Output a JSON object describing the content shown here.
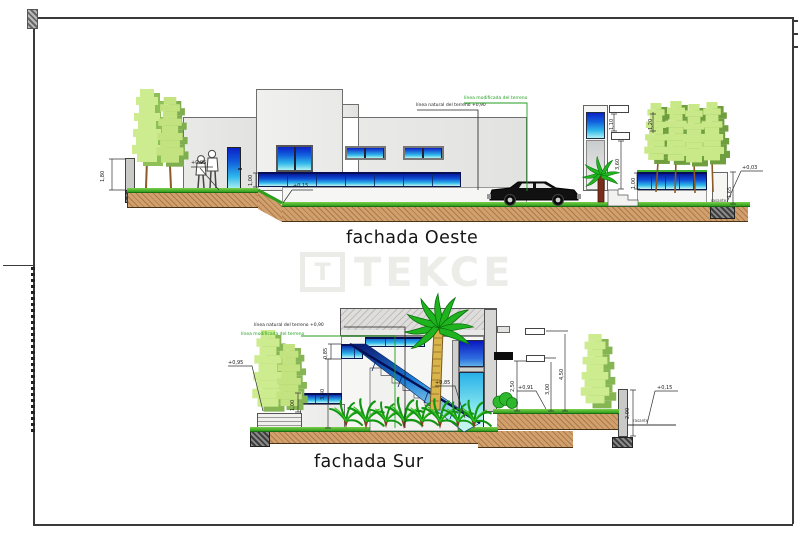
{
  "colors": {
    "window_blue_top": "#0b22c8",
    "window_cyan_bottom": "#aff2f2",
    "grass_green": "#2f9e1d",
    "earth_brown": "#d1a06c",
    "tree_light_green": "#cdeb8f",
    "tree_dark_green": "#86b554",
    "palm_green": "#1fb41f",
    "terrain_modified_green": "#1f9e1f",
    "watermark_gray": "#ebebe8",
    "wall_gray": "#e8e8e6"
  },
  "watermark": {
    "logo_letter": "T",
    "brand": "TEKCE"
  },
  "oeste": {
    "title": "fachada Oeste",
    "terrain_natural": "línea natural del terreno +0,90",
    "terrain_modified": "línea modificada del terreno",
    "dim_wall_left": "1,80",
    "level_entry": "+0,95",
    "dim_strip_window": "1,00",
    "level_ground": "+0,15",
    "dim_parapet_left": "1,10",
    "dim_parapet_right": "1,20",
    "dim_tower": "3,60",
    "dim_fence": "1,00",
    "dim_pillar": "1,65",
    "level_right": "+0,03",
    "grade_note": "rasante"
  },
  "sur": {
    "title": "fachada Sur",
    "terrain_natural": "línea natural del terreno +0,90",
    "terrain_modified": "línea modificada del terreno",
    "level_garden": "+0,95",
    "dim_balustrade": "0,85",
    "dim_stairs": "3,30",
    "dim_window_strip": "1,00",
    "level_stairs": "+0,85",
    "dim_left": "2,50",
    "level_terrace": "+0,91",
    "dim_mid": "3,00",
    "dim_total": "4,50",
    "dim_wall_right": "2,00",
    "level_street": "+0,15",
    "grade_note": "rasante"
  }
}
